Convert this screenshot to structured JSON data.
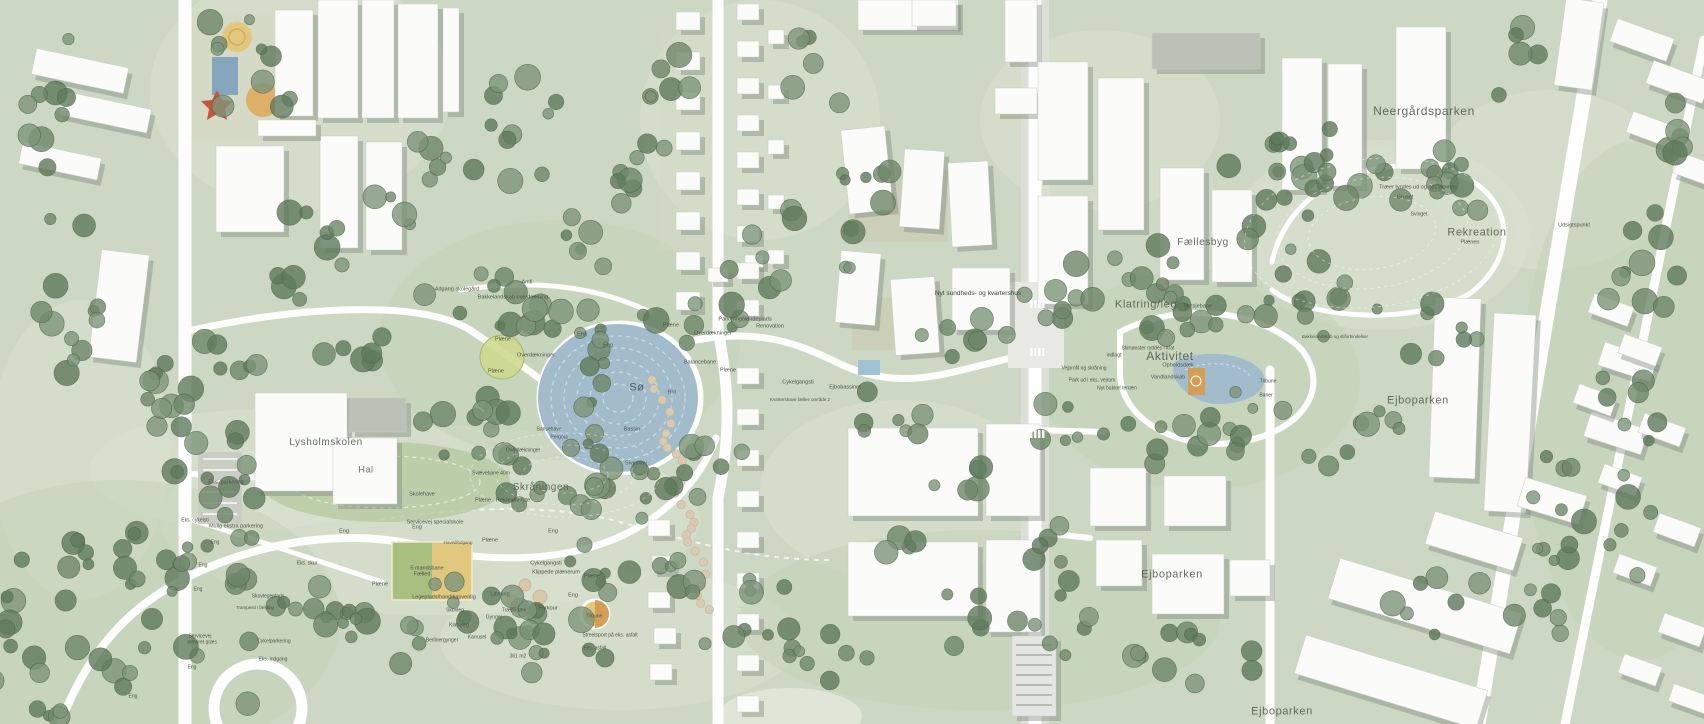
{
  "map": {
    "type": "landscape-masterplan",
    "colors": {
      "base": "#ccd8c3",
      "lawn_light": "#d8e1cf",
      "meadow": "#c3d2b8",
      "hill_light": "#d5dfcb",
      "tree_dark": "#5f7a5c",
      "tree_mid": "#6f8769",
      "tree_light": "#7e957a",
      "water": "#a3bccb",
      "water_ring": "#d6e2e9",
      "building": "#fbfcf9",
      "building_shadow": "#7e877e",
      "roof_gray": "#bcc1b8",
      "path": "#ffffff",
      "field_green": "#a9bf80",
      "field_sand": "#e2c87e",
      "court_orange": "#d49e56",
      "stone": "#d9cab2",
      "label": "#4d544b"
    },
    "area_labels": [
      {
        "t": "Neergårdsparken",
        "x": 1424,
        "y": 111,
        "s": 12,
        "cls": "xl"
      },
      {
        "t": "Rekreation",
        "x": 1477,
        "y": 233,
        "s": 11,
        "cls": "xl"
      },
      {
        "t": "Fællesbyg",
        "x": 1203,
        "y": 243,
        "s": 10,
        "cls": "xl"
      },
      {
        "t": "Klatring/leg",
        "x": 1146,
        "y": 305,
        "s": 11,
        "cls": "xl"
      },
      {
        "t": "Aktivitet",
        "x": 1170,
        "y": 356,
        "s": 12,
        "cls": "xl"
      },
      {
        "t": "Ejboparken",
        "x": 1418,
        "y": 401,
        "s": 11,
        "cls": "xl"
      },
      {
        "t": "Ejboparken",
        "x": 1172,
        "y": 575,
        "s": 11,
        "cls": "xl"
      },
      {
        "t": "Ejboparken",
        "x": 1282,
        "y": 712,
        "s": 11,
        "cls": "xl"
      },
      {
        "t": "Lysholmskolen",
        "x": 326,
        "y": 443,
        "s": 10,
        "cls": "xl"
      },
      {
        "t": "Hal",
        "x": 366,
        "y": 470,
        "s": 9,
        "cls": "xl"
      },
      {
        "t": "Skråningen",
        "x": 541,
        "y": 488,
        "s": 10,
        "cls": "xl"
      },
      {
        "t": "Sø",
        "x": 637,
        "y": 388,
        "s": 11,
        "cls": "xl water"
      }
    ],
    "small_labels": [
      {
        "t": "Nyt sundheds- og kvartershus",
        "x": 978,
        "y": 294,
        "s": 6.5,
        "cls": "dark"
      },
      {
        "t": "Træer tyndes ud og opstammes",
        "x": 1418,
        "y": 188,
        "s": 5.5
      },
      {
        "t": "Gruset",
        "x": 1405,
        "y": 198,
        "s": 5.5
      },
      {
        "t": "Svinget",
        "x": 1419,
        "y": 215,
        "s": 5
      },
      {
        "t": "Plænen",
        "x": 1470,
        "y": 243,
        "s": 5.5
      },
      {
        "t": "Udsigtspunkt",
        "x": 1574,
        "y": 226,
        "s": 5.5
      },
      {
        "t": "Rutsjebane",
        "x": 1198,
        "y": 307,
        "s": 5.5
      },
      {
        "t": "Opholdsdæk",
        "x": 1178,
        "y": 366,
        "s": 5.5
      },
      {
        "t": "Vandlandskab",
        "x": 1168,
        "y": 378,
        "s": 5.5
      },
      {
        "t": "Tribune",
        "x": 1268,
        "y": 382,
        "s": 5
      },
      {
        "t": "Baner",
        "x": 1266,
        "y": 396,
        "s": 5
      },
      {
        "t": "Stimønster ryddes i krat",
        "x": 1148,
        "y": 349,
        "s": 5
      },
      {
        "t": "indlagt",
        "x": 1114,
        "y": 356,
        "s": 5
      },
      {
        "t": "Vejprofil og skråning",
        "x": 1084,
        "y": 369,
        "s": 5
      },
      {
        "t": "Park ud i eks. vejrum",
        "x": 1092,
        "y": 381,
        "s": 5
      },
      {
        "t": "Nyt bakket terræn",
        "x": 1117,
        "y": 389,
        "s": 5
      },
      {
        "t": "Bakkelandskab og stiforbindelser",
        "x": 1335,
        "y": 337,
        "s": 4.5
      },
      {
        "t": "Parkering/vendeplads",
        "x": 745,
        "y": 320,
        "s": 5.5
      },
      {
        "t": "Renovation",
        "x": 770,
        "y": 327,
        "s": 5.5
      },
      {
        "t": "Overdækninger",
        "x": 713,
        "y": 334,
        "s": 5.5
      },
      {
        "t": "Plæne",
        "x": 671,
        "y": 326,
        "s": 5.5
      },
      {
        "t": "Balancebane",
        "x": 700,
        "y": 363,
        "s": 5.5
      },
      {
        "t": "Plæne",
        "x": 728,
        "y": 371,
        "s": 5.5
      },
      {
        "t": "Cykelgangsti",
        "x": 798,
        "y": 383,
        "s": 5.5
      },
      {
        "t": "Ejbobassinet",
        "x": 845,
        "y": 388,
        "s": 5.5
      },
      {
        "t": "Kvartershave fælles område 2",
        "x": 800,
        "y": 400,
        "s": 4.5
      },
      {
        "t": "Adgang skolegård",
        "x": 457,
        "y": 290,
        "s": 5.5
      },
      {
        "t": "Amfi",
        "x": 527,
        "y": 283,
        "s": 5.5
      },
      {
        "t": "Bakkelandskab overdækning",
        "x": 513,
        "y": 298,
        "s": 5.5
      },
      {
        "t": "Plæne",
        "x": 503,
        "y": 340,
        "s": 5.5
      },
      {
        "t": "Eng",
        "x": 582,
        "y": 335,
        "s": 5.5
      },
      {
        "t": "Eng",
        "x": 608,
        "y": 346,
        "s": 5.5
      },
      {
        "t": "Overdækninger",
        "x": 536,
        "y": 356,
        "s": 5.5
      },
      {
        "t": "Plæne",
        "x": 496,
        "y": 372,
        "s": 5.5
      },
      {
        "t": "Bro",
        "x": 672,
        "y": 393,
        "s": 5.5
      },
      {
        "t": "Bassin",
        "x": 632,
        "y": 430,
        "s": 5.5
      },
      {
        "t": "Siveskov",
        "x": 636,
        "y": 464,
        "s": 5.5
      },
      {
        "t": "Sansehave",
        "x": 549,
        "y": 430,
        "s": 5
      },
      {
        "t": "Pergola",
        "x": 559,
        "y": 438,
        "s": 5
      },
      {
        "t": "Overdækninger",
        "x": 523,
        "y": 451,
        "s": 5
      },
      {
        "t": "Svævebane 40m",
        "x": 491,
        "y": 474,
        "s": 5
      },
      {
        "t": "Plæne",
        "x": 483,
        "y": 501,
        "s": 5.5
      },
      {
        "t": "Rekreativ rute",
        "x": 513,
        "y": 501,
        "s": 5.5
      },
      {
        "t": "Skolehave",
        "x": 422,
        "y": 495,
        "s": 5.5
      },
      {
        "t": "Servicevej specialskole",
        "x": 435,
        "y": 523,
        "s": 5.5
      },
      {
        "t": "Eng",
        "x": 417,
        "y": 528,
        "s": 5.5
      },
      {
        "t": "Eng",
        "x": 344,
        "y": 532,
        "s": 5.5
      },
      {
        "t": "Eng",
        "x": 553,
        "y": 532,
        "s": 5.5
      },
      {
        "t": "Eks. parkering",
        "x": 226,
        "y": 483,
        "s": 5.5
      },
      {
        "t": "Eks. cykelsti",
        "x": 195,
        "y": 521,
        "s": 5
      },
      {
        "t": "Mulig ekstra parkering",
        "x": 236,
        "y": 527,
        "s": 5.5
      },
      {
        "t": "Eng",
        "x": 215,
        "y": 543,
        "s": 5
      },
      {
        "t": "Eks. skur",
        "x": 307,
        "y": 564,
        "s": 5
      },
      {
        "t": "Eng",
        "x": 203,
        "y": 566,
        "s": 5
      },
      {
        "t": "Plæne",
        "x": 490,
        "y": 541,
        "s": 5.5
      },
      {
        "t": "Hovedindgang",
        "x": 458,
        "y": 543,
        "s": 4.5
      },
      {
        "t": "5 mandsbane",
        "x": 427,
        "y": 569,
        "s": 5.5
      },
      {
        "t": "Fælled",
        "x": 422,
        "y": 575,
        "s": 5.5
      },
      {
        "t": "Plæne",
        "x": 380,
        "y": 585,
        "s": 5.5
      },
      {
        "t": "Legeplads/handikapvenlig",
        "x": 444,
        "y": 598,
        "s": 5.5
      },
      {
        "t": "Lavning",
        "x": 500,
        "y": 595,
        "s": 5.5
      },
      {
        "t": "Cykelgangsti",
        "x": 546,
        "y": 564,
        "s": 5.5
      },
      {
        "t": "Klippede plænerum",
        "x": 556,
        "y": 573,
        "s": 5.5
      },
      {
        "t": "Plæne",
        "x": 592,
        "y": 577,
        "s": 5.5
      },
      {
        "t": "Eng",
        "x": 573,
        "y": 596,
        "s": 5.5
      },
      {
        "t": "Parkour",
        "x": 548,
        "y": 609,
        "s": 5.5
      },
      {
        "t": "Trædedæk",
        "x": 514,
        "y": 611,
        "s": 5
      },
      {
        "t": "Skovleg",
        "x": 455,
        "y": 611,
        "s": 5
      },
      {
        "t": "Gynger",
        "x": 494,
        "y": 618,
        "s": 5
      },
      {
        "t": "Klatreleg",
        "x": 459,
        "y": 626,
        "s": 5
      },
      {
        "t": "Karrusel",
        "x": 477,
        "y": 638,
        "s": 5
      },
      {
        "t": "Berlinergynger",
        "x": 442,
        "y": 641,
        "s": 5
      },
      {
        "t": "Tribune",
        "x": 594,
        "y": 617,
        "s": 5
      },
      {
        "t": "Streetsport på eks. asfalt",
        "x": 610,
        "y": 636,
        "s": 5
      },
      {
        "t": "Eks. asfalt",
        "x": 595,
        "y": 649,
        "s": 5
      },
      {
        "t": "361 m2",
        "x": 518,
        "y": 657,
        "s": 5
      },
      {
        "t": "Skovlegeplads",
        "x": 268,
        "y": 597,
        "s": 5
      },
      {
        "t": "Trampesti i fælding",
        "x": 255,
        "y": 608,
        "s": 4.5
      },
      {
        "t": "Servicevej",
        "x": 200,
        "y": 637,
        "s": 5
      },
      {
        "t": "armeret græs",
        "x": 202,
        "y": 643,
        "s": 5
      },
      {
        "t": "Cykelparkering",
        "x": 274,
        "y": 642,
        "s": 5
      },
      {
        "t": "Eks. indgang",
        "x": 273,
        "y": 660,
        "s": 5
      },
      {
        "t": "Eng",
        "x": 192,
        "y": 668,
        "s": 5
      },
      {
        "t": "Eng",
        "x": 133,
        "y": 697,
        "s": 5
      },
      {
        "t": "Eng",
        "x": 198,
        "y": 590,
        "s": 5
      }
    ]
  }
}
